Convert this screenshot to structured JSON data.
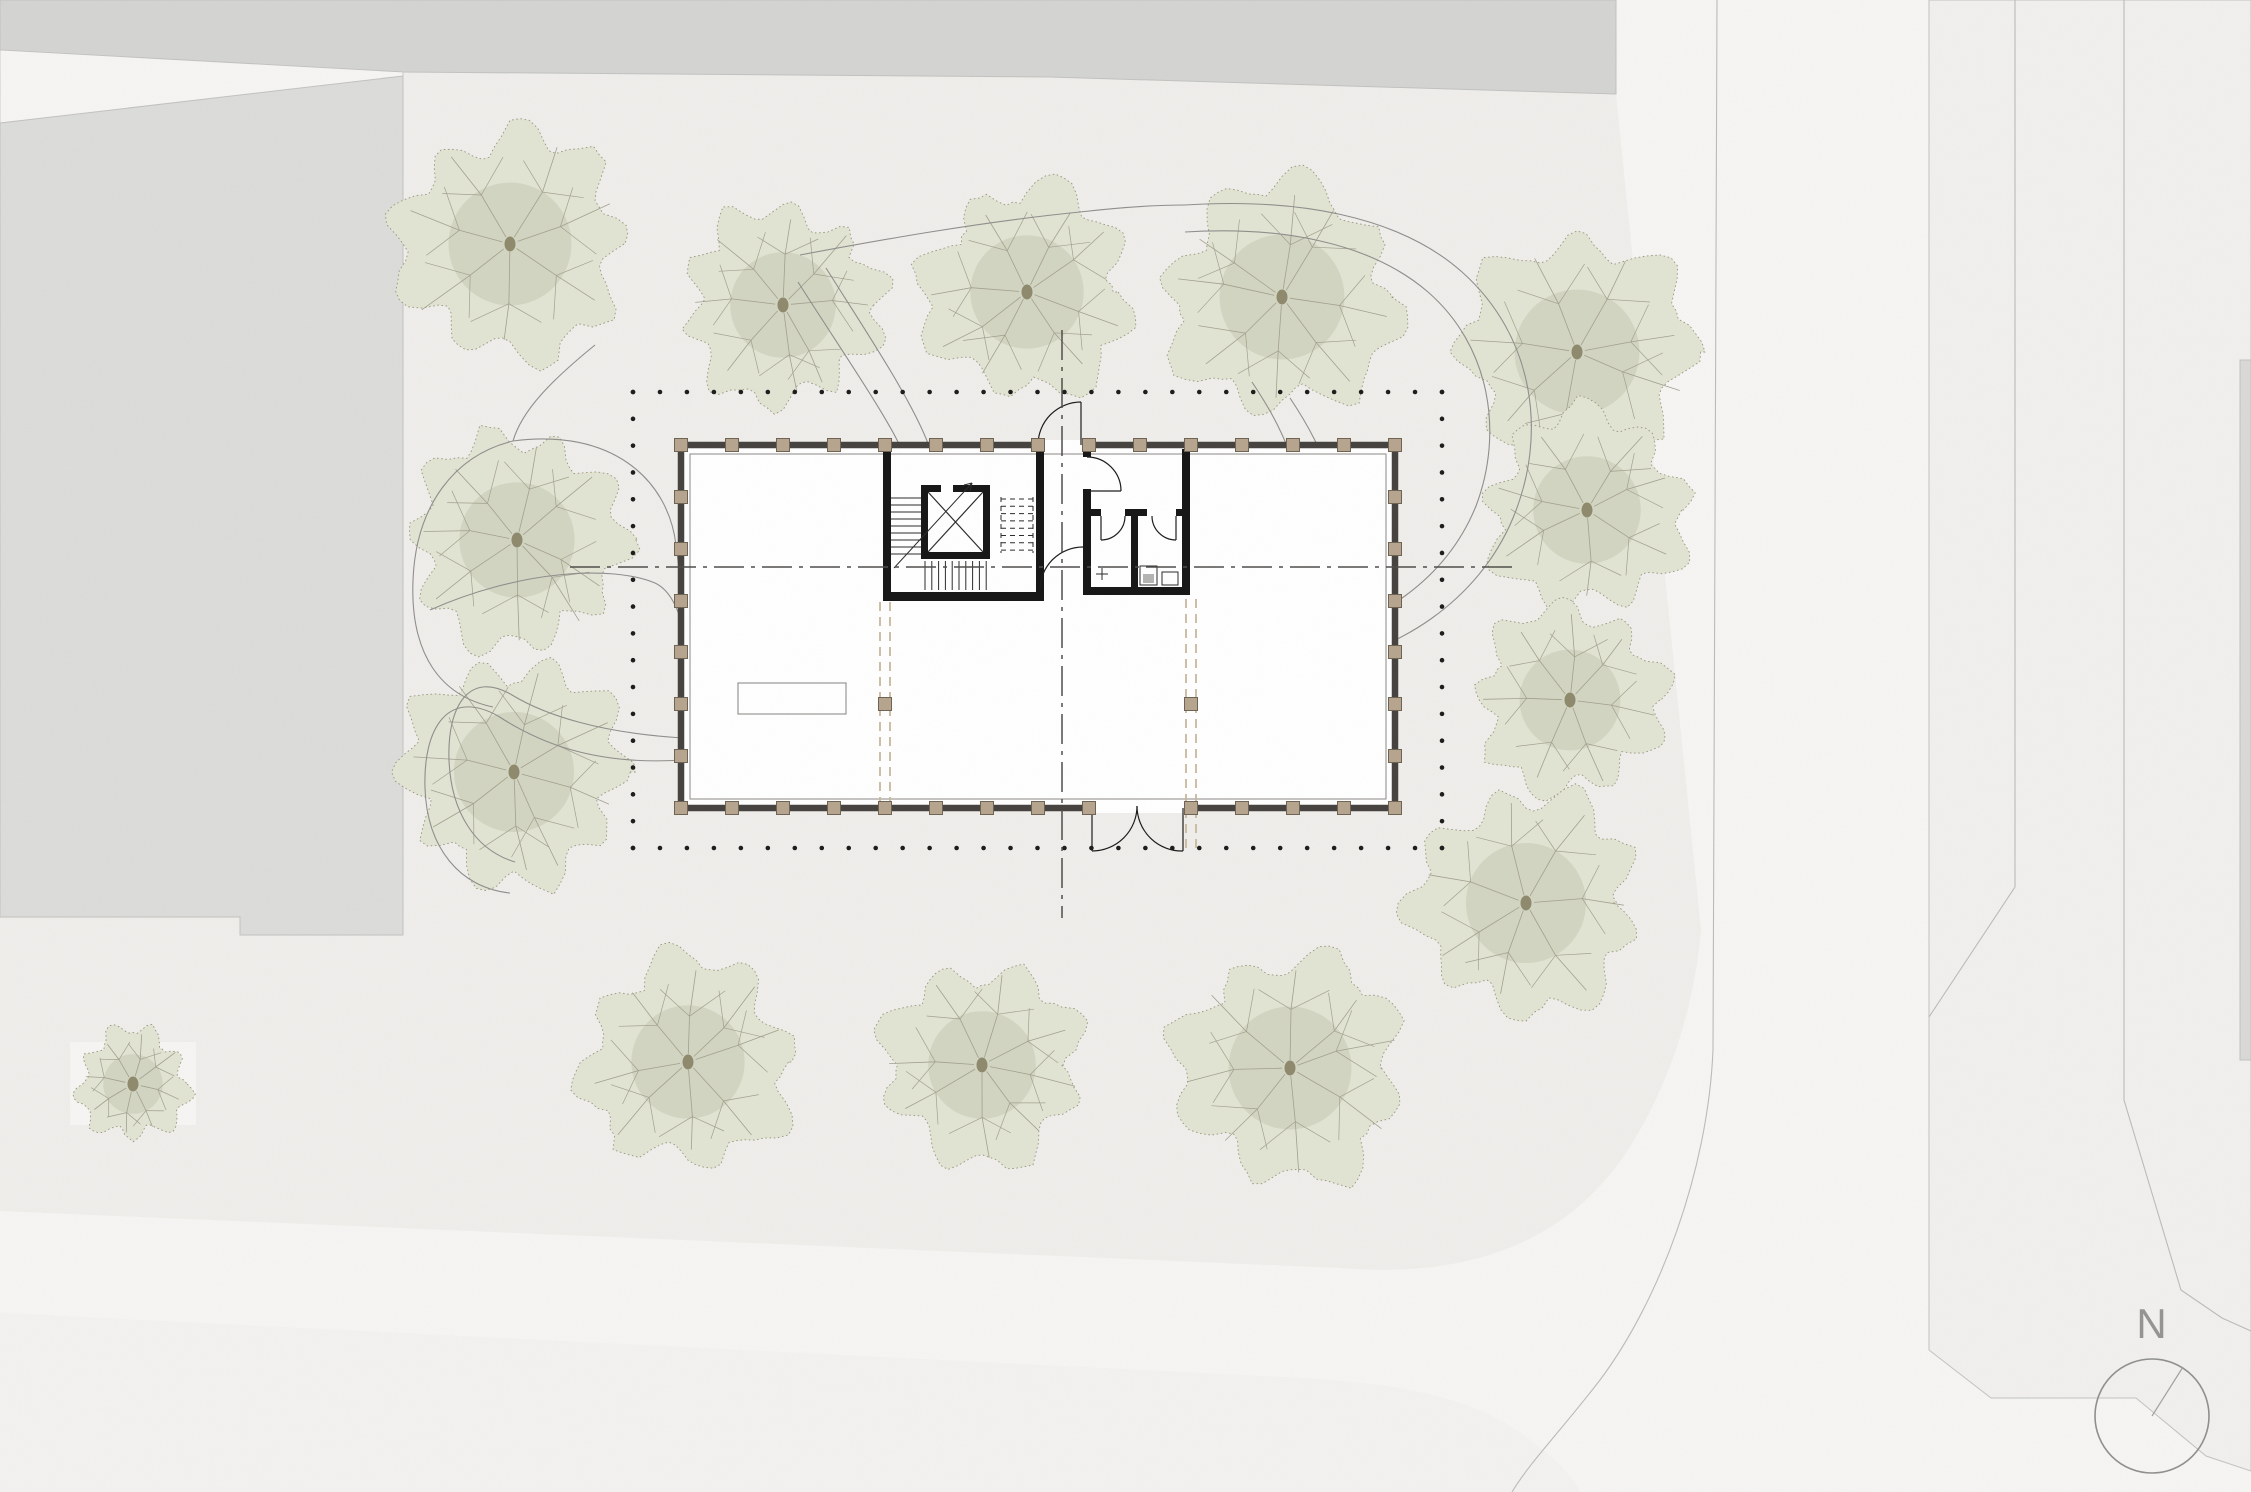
{
  "compass": {
    "label": "N"
  },
  "canvas": {
    "width": 2251,
    "height": 1492
  },
  "colors": {
    "site": "#efeeeb",
    "road": "#f6f5f3",
    "roadSouth": "#f3f2f0",
    "sidewalk": "#f1f0ee",
    "bandGray": "#d4d4d2",
    "leftBlock": "#dcdcda",
    "trBlock": "#d6d6d4",
    "sliver": "#d9d9d7",
    "blockEdge": "#c2c2c0",
    "roadLine": "#bcbbb9",
    "pathLine": "#8f8e8c",
    "dots": "#1c1c1c",
    "centerline": "#4f4d4a",
    "wall": "#454240",
    "wallInner": "#8b8987",
    "core": "#161616",
    "stair": "#2b2b2b",
    "colFill": "#b7a58e",
    "colEdge": "#6f6453",
    "tanDash": "#c9b89f",
    "deskEdge": "#8d8d8b",
    "door": "#1c1c1c",
    "white": "#ffffff",
    "fixtureFill": "#b4b4b2",
    "treeFill": "#e2e4d3",
    "treeEdge": "#9b957e",
    "treeBranch": "#a3a08e",
    "treeInner": "#c2c6af",
    "treeDot": "#8f8a6e",
    "compassRing": "#8f8f8d",
    "needle": "#a0a09e"
  },
  "draw": [
    {
      "t": "rect",
      "n": "site-ground",
      "x": 0,
      "y": 0,
      "w": 2251,
      "h": 1492,
      "fill": "site"
    },
    {
      "t": "path",
      "n": "road-east-south",
      "d": "M1616,0 L1616,94 L1701,930 C1694,1010 1668,1090 1624,1156 C1560,1248 1460,1278 1340,1268 L0,1211 L0,1313 L1300,1378 C1420,1385 1480,1402 1530,1440 C1552,1457 1570,1472 1580,1492 L2251,1492 L2251,0 Z",
      "fill": "road"
    },
    {
      "t": "path",
      "n": "road-south-verge",
      "d": "M0,1313 L1300,1378 C1420,1385 1480,1402 1530,1440 C1552,1457 1570,1472 1580,1492 L0,1492 Z",
      "fill": "roadSouth"
    },
    {
      "t": "poly",
      "n": "block-top-band",
      "p": "0,0 1616,0 1616,94 1050,77 403,72 0,50",
      "fill": "bandGray",
      "stroke": "blockEdge",
      "sw": 1
    },
    {
      "t": "poly",
      "n": "road-top-wedge",
      "p": "0,50 403,72 403,78 0,123",
      "fill": "road",
      "stroke": "blockEdge",
      "sw": 0.8
    },
    {
      "t": "poly",
      "n": "block-left",
      "p": "0,123 403,76 403,935 240,935 240,917 0,917",
      "fill": "leftBlock",
      "stroke": "blockEdge",
      "sw": 1
    },
    {
      "t": "poly",
      "n": "block-top-right",
      "p": "2016,0 2251,0 2251,118 2016,108",
      "fill": "trBlock",
      "stroke": "blockEdge",
      "sw": 1
    },
    {
      "t": "poly",
      "n": "sidewalk-east",
      "p": "1929,0 1929,1350 1991,1398 2136,1398 2206,1456 2251,1471 2251,0",
      "fill": "sidewalk",
      "stroke": "blockEdge",
      "sw": 1
    },
    {
      "t": "rect",
      "n": "block-east-sliver",
      "x": 2240,
      "y": 360,
      "w": 11,
      "h": 700,
      "fill": "sliver",
      "stroke": "blockEdge",
      "sw": 1
    },
    {
      "t": "rect",
      "n": "small-tree-plot",
      "x": 70,
      "y": 1042,
      "w": 126,
      "h": 83,
      "fill": "road"
    },
    {
      "t": "path",
      "n": "curb-east",
      "d": "M1717,0 L1713,1050 C1708,1170 1660,1300 1600,1380 C1560,1432 1530,1462 1512,1492",
      "stroke": "roadLine",
      "sw": 1.1
    },
    {
      "t": "path",
      "n": "curb-east-lane",
      "d": "M2015,0 L2015,887 L1929,1017",
      "stroke": "roadLine",
      "sw": 1.1
    },
    {
      "t": "path",
      "n": "curb-east-outer",
      "d": "M2124,0 L2124,1100 L2181,1290 L2222,1318 L2251,1331",
      "stroke": "roadLine",
      "sw": 1.1
    },
    {
      "t": "tree",
      "n": "tree",
      "cx": 510,
      "cy": 244,
      "r": 128,
      "seed": 11
    },
    {
      "t": "tree",
      "n": "tree",
      "cx": 783,
      "cy": 305,
      "r": 110,
      "seed": 23
    },
    {
      "t": "tree",
      "n": "tree",
      "cx": 1027,
      "cy": 292,
      "r": 118,
      "seed": 37
    },
    {
      "t": "tree",
      "n": "tree",
      "cx": 1282,
      "cy": 297,
      "r": 130,
      "seed": 41
    },
    {
      "t": "tree",
      "n": "tree",
      "cx": 1577,
      "cy": 352,
      "r": 130,
      "seed": 53
    },
    {
      "t": "tree",
      "n": "tree",
      "cx": 1587,
      "cy": 510,
      "r": 112,
      "seed": 67
    },
    {
      "t": "tree",
      "n": "tree",
      "cx": 1570,
      "cy": 700,
      "r": 105,
      "seed": 71
    },
    {
      "t": "tree",
      "n": "tree",
      "cx": 1526,
      "cy": 903,
      "r": 125,
      "seed": 83
    },
    {
      "t": "tree",
      "n": "tree",
      "cx": 517,
      "cy": 540,
      "r": 120,
      "seed": 97
    },
    {
      "t": "tree",
      "n": "tree",
      "cx": 514,
      "cy": 772,
      "r": 125,
      "seed": 103
    },
    {
      "t": "tree",
      "n": "tree",
      "cx": 688,
      "cy": 1062,
      "r": 118,
      "seed": 113
    },
    {
      "t": "tree",
      "n": "tree",
      "cx": 982,
      "cy": 1065,
      "r": 112,
      "seed": 127
    },
    {
      "t": "tree",
      "n": "tree",
      "cx": 1290,
      "cy": 1068,
      "r": 128,
      "seed": 131
    },
    {
      "t": "tree",
      "n": "tree-small",
      "cx": 133,
      "cy": 1084,
      "r": 62,
      "seed": 139
    },
    {
      "t": "path",
      "n": "footpath",
      "d": "M595,345 C552,380 522,410 513,441",
      "stroke": "pathLine",
      "sw": 1.1
    },
    {
      "t": "path",
      "n": "footpath",
      "d": "M513,441 C455,455 416,505 413,580 C410,655 441,696 493,707",
      "stroke": "pathLine",
      "sw": 1.1
    },
    {
      "t": "path",
      "n": "footpath",
      "d": "M513,441 C610,428 668,478 676,545 C679,568 681,585 683,605",
      "stroke": "pathLine",
      "sw": 1.1
    },
    {
      "t": "path",
      "n": "footpath",
      "d": "M430,610 C520,570 612,565 655,583 C670,590 678,608 683,628",
      "stroke": "pathLine",
      "sw": 1.1
    },
    {
      "t": "path",
      "n": "footpath",
      "d": "M683,605 C840,612 988,625 988,700 C988,775 840,766 683,760",
      "stroke": "pathLine",
      "sw": 1.1
    },
    {
      "t": "path",
      "n": "footpath",
      "d": "M683,628 C805,633 942,650 942,700 C942,750 805,742 683,738",
      "stroke": "pathLine",
      "sw": 1.1
    },
    {
      "t": "path",
      "n": "footpath",
      "d": "M683,760 C590,766 535,740 498,716 C448,688 423,728 425,788 C427,848 460,888 510,893",
      "stroke": "pathLine",
      "sw": 1.1
    },
    {
      "t": "path",
      "n": "footpath",
      "d": "M683,738 C600,733 545,715 512,695 C470,670 447,705 449,760 C451,812 475,850 515,862",
      "stroke": "pathLine",
      "sw": 1.1
    },
    {
      "t": "path",
      "n": "footpath",
      "d": "M800,255 C880,240 980,222 1080,212 C1115,208 1150,205 1185,205",
      "stroke": "pathLine",
      "sw": 1.1
    },
    {
      "t": "path",
      "n": "footpath",
      "d": "M826,268 C865,330 912,400 929,446",
      "stroke": "pathLine",
      "sw": 1.1
    },
    {
      "t": "path",
      "n": "footpath",
      "d": "M798,282 C838,345 884,412 900,446",
      "stroke": "pathLine",
      "sw": 1.1
    },
    {
      "t": "path",
      "n": "footpath",
      "d": "M1185,205 C1295,198 1398,215 1462,272 C1534,336 1548,434 1513,518 C1478,602 1396,653 1318,664 C1266,671 1234,650 1229,612",
      "stroke": "pathLine",
      "sw": 1.1
    },
    {
      "t": "path",
      "n": "footpath",
      "d": "M1185,232 C1280,226 1370,242 1428,292 C1490,346 1504,432 1476,506 C1446,580 1376,626 1307,637 C1264,643 1242,628 1238,597",
      "stroke": "pathLine",
      "sw": 1.1
    },
    {
      "t": "path",
      "n": "footpath",
      "d": "M1252,382 C1272,412 1286,438 1296,472 C1307,510 1316,542 1323,568",
      "stroke": "pathLine",
      "sw": 1.1
    },
    {
      "t": "path",
      "n": "footpath",
      "d": "M1290,398 C1310,428 1322,452 1331,480 C1339,506 1347,527 1353,545",
      "stroke": "pathLine",
      "sw": 1.1
    },
    {
      "t": "dots",
      "n": "roof-projection-top",
      "x1": 633,
      "y1": 392,
      "x2": 1442,
      "y2": 392,
      "sp": 27,
      "r": 2.3
    },
    {
      "t": "dots",
      "n": "roof-projection-bottom",
      "x1": 633,
      "y1": 848,
      "x2": 1442,
      "y2": 848,
      "sp": 27,
      "r": 2.3
    },
    {
      "t": "dots",
      "n": "roof-projection-left",
      "x1": 633,
      "y1": 392,
      "x2": 633,
      "y2": 848,
      "sp": 27,
      "r": 2.3
    },
    {
      "t": "dots",
      "n": "roof-projection-right",
      "x1": 1442,
      "y1": 392,
      "x2": 1442,
      "y2": 848,
      "sp": 27,
      "r": 2.3
    },
    {
      "t": "rect",
      "n": "building-floor",
      "x": 681,
      "y": 445,
      "w": 714,
      "h": 363,
      "fill": "white",
      "stroke": "wall",
      "sw": 6.5
    },
    {
      "t": "rect",
      "n": "building-glazing-line",
      "x": 690,
      "y": 454,
      "w": 696,
      "h": 345,
      "fill": "none",
      "stroke": "wallInner",
      "sw": 1
    },
    {
      "t": "rect",
      "n": "door-opening-mask",
      "x": 1036,
      "y": 440,
      "w": 47,
      "h": 10,
      "fill": "white"
    },
    {
      "t": "rect",
      "n": "door-opening-mask",
      "x": 1090,
      "y": 803,
      "w": 95,
      "h": 10,
      "fill": "white"
    },
    {
      "t": "line",
      "n": "void-edge-dashed",
      "x1": 880,
      "y1": 602,
      "x2": 880,
      "y2": 810,
      "stroke": "tanDash",
      "sw": 1.8,
      "dash": "9 6"
    },
    {
      "t": "line",
      "n": "void-edge-dashed",
      "x1": 890,
      "y1": 602,
      "x2": 890,
      "y2": 810,
      "stroke": "tanDash",
      "sw": 1.8,
      "dash": "9 6"
    },
    {
      "t": "line",
      "n": "void-edge-dashed",
      "x1": 1186,
      "y1": 599,
      "x2": 1186,
      "y2": 848,
      "stroke": "tanDash",
      "sw": 1.8,
      "dash": "9 6"
    },
    {
      "t": "line",
      "n": "void-edge-dashed",
      "x1": 1196,
      "y1": 599,
      "x2": 1196,
      "y2": 848,
      "stroke": "tanDash",
      "sw": 1.8,
      "dash": "9 6"
    },
    {
      "t": "rect",
      "n": "reception-desk",
      "x": 738,
      "y": 683,
      "w": 108,
      "h": 31,
      "fill": "white",
      "stroke": "deskEdge",
      "sw": 1.1
    },
    {
      "t": "rect",
      "n": "stair-core-wall",
      "x": 883,
      "y": 449,
      "w": 8,
      "h": 150,
      "fill": "core"
    },
    {
      "t": "rect",
      "n": "stair-core-wall",
      "x": 883,
      "y": 592,
      "w": 161,
      "h": 9,
      "fill": "core"
    },
    {
      "t": "rect",
      "n": "stair-core-wall",
      "x": 1036,
      "y": 449,
      "w": 8,
      "h": 152,
      "fill": "core"
    },
    {
      "t": "rect",
      "n": "elevator-wall",
      "x": 921,
      "y": 485,
      "w": 20,
      "h": 7,
      "fill": "core"
    },
    {
      "t": "rect",
      "n": "elevator-wall",
      "x": 953,
      "y": 485,
      "w": 37,
      "h": 7,
      "fill": "core"
    },
    {
      "t": "rect",
      "n": "elevator-wall",
      "x": 921,
      "y": 485,
      "w": 7,
      "h": 74,
      "fill": "core"
    },
    {
      "t": "rect",
      "n": "elevator-wall",
      "x": 983,
      "y": 485,
      "w": 7,
      "h": 74,
      "fill": "core"
    },
    {
      "t": "rect",
      "n": "elevator-wall",
      "x": 921,
      "y": 552,
      "w": 69,
      "h": 7,
      "fill": "core"
    },
    {
      "t": "line",
      "n": "elevator-x",
      "x1": 928,
      "y1": 492,
      "x2": 983,
      "y2": 552,
      "stroke": "stair",
      "sw": 1.2
    },
    {
      "t": "line",
      "n": "elevator-x",
      "x1": 983,
      "y1": 492,
      "x2": 928,
      "y2": 552,
      "stroke": "stair",
      "sw": 1.2
    },
    {
      "t": "stairs",
      "n": "stair-treads-left",
      "x1": 891,
      "x2": 921,
      "y": 498,
      "step": 7,
      "count": 9,
      "dir": "h"
    },
    {
      "t": "stairs",
      "n": "stair-treads-bottom",
      "y1": 561,
      "y2": 590,
      "x": 925,
      "step": 6.8,
      "count": 10,
      "dir": "v"
    },
    {
      "t": "stairs",
      "n": "stair-treads-upper-dashed",
      "x1": 1001,
      "x2": 1033,
      "y": 499,
      "step": 7.3,
      "count": 8,
      "dir": "h",
      "dash": "5 4"
    },
    {
      "t": "line",
      "n": "stair-flight-edge",
      "x1": 1001,
      "y1": 497,
      "x2": 1001,
      "y2": 553,
      "stroke": "stair",
      "sw": 1,
      "dash": "5 4"
    },
    {
      "t": "line",
      "n": "stair-flight-edge",
      "x1": 1033,
      "y1": 497,
      "x2": 1033,
      "y2": 553,
      "stroke": "stair",
      "sw": 1,
      "dash": "5 4"
    },
    {
      "t": "line",
      "n": "stair-direction",
      "x1": 894,
      "y1": 568,
      "x2": 972,
      "y2": 483,
      "stroke": "stair",
      "sw": 1
    },
    {
      "t": "line",
      "n": "stair-arrow",
      "x1": 972,
      "y1": 483,
      "x2": 964,
      "y2": 485,
      "stroke": "stair",
      "sw": 1
    },
    {
      "t": "line",
      "n": "stair-arrow",
      "x1": 972,
      "y1": 483,
      "x2": 970,
      "y2": 491,
      "stroke": "stair",
      "sw": 1
    },
    {
      "t": "rect",
      "n": "wc-core-wall",
      "x": 1083,
      "y": 449,
      "w": 8,
      "h": 8,
      "fill": "core"
    },
    {
      "t": "rect",
      "n": "wc-core-wall",
      "x": 1083,
      "y": 489,
      "w": 8,
      "h": 106,
      "fill": "core"
    },
    {
      "t": "rect",
      "n": "wc-core-wall",
      "x": 1182,
      "y": 449,
      "w": 8,
      "h": 146,
      "fill": "core"
    },
    {
      "t": "rect",
      "n": "wc-core-wall",
      "x": 1083,
      "y": 587,
      "w": 107,
      "h": 8,
      "fill": "core"
    },
    {
      "t": "rect",
      "n": "wc-partition",
      "x": 1091,
      "y": 509,
      "w": 10,
      "h": 7,
      "fill": "core"
    },
    {
      "t": "rect",
      "n": "wc-partition",
      "x": 1125,
      "y": 509,
      "w": 22,
      "h": 7,
      "fill": "core"
    },
    {
      "t": "rect",
      "n": "wc-partition",
      "x": 1176,
      "y": 509,
      "w": 6,
      "h": 7,
      "fill": "core"
    },
    {
      "t": "rect",
      "n": "wc-divider",
      "x": 1131,
      "y": 516,
      "w": 7,
      "h": 71,
      "fill": "core"
    },
    {
      "t": "rect",
      "n": "wc-fixture",
      "x": 1140,
      "y": 566,
      "w": 17,
      "h": 19,
      "fill": "none",
      "stroke": "stair",
      "sw": 1
    },
    {
      "t": "rect",
      "n": "wc-fixture",
      "x": 1162,
      "y": 572,
      "w": 16,
      "h": 13,
      "fill": "none",
      "stroke": "stair",
      "sw": 1
    },
    {
      "t": "rect",
      "n": "wc-fixture-fill",
      "x": 1143,
      "y": 574,
      "w": 11,
      "h": 9,
      "fill": "fixtureFill"
    },
    {
      "t": "line",
      "n": "wc-mark",
      "x1": 1096,
      "y1": 574,
      "x2": 1108,
      "y2": 574,
      "stroke": "stair",
      "sw": 1
    },
    {
      "t": "line",
      "n": "wc-mark",
      "x1": 1102,
      "y1": 568,
      "x2": 1102,
      "y2": 580,
      "stroke": "stair",
      "sw": 1
    },
    {
      "t": "path",
      "n": "door-swing",
      "d": "M1038,445 A43,43 0 0 1 1081,402",
      "stroke": "door",
      "sw": 1.2
    },
    {
      "t": "line",
      "n": "door-leaf",
      "x1": 1081,
      "y1": 445,
      "x2": 1081,
      "y2": 402,
      "stroke": "door",
      "sw": 1.2
    },
    {
      "t": "path",
      "n": "door-swing",
      "d": "M1092,851 A45,45 0 0 0 1137,806",
      "stroke": "door",
      "sw": 1.2
    },
    {
      "t": "line",
      "n": "door-leaf",
      "x1": 1092,
      "y1": 808,
      "x2": 1092,
      "y2": 851,
      "stroke": "door",
      "sw": 1.2
    },
    {
      "t": "path",
      "n": "door-swing",
      "d": "M1183,851 A45,45 0 0 1 1137,806",
      "stroke": "door",
      "sw": 1.2
    },
    {
      "t": "line",
      "n": "door-leaf",
      "x1": 1183,
      "y1": 808,
      "x2": 1183,
      "y2": 851,
      "stroke": "door",
      "sw": 1.2
    },
    {
      "t": "path",
      "n": "door-swing",
      "d": "M1087,457 A34,34 0 0 1 1121,491",
      "stroke": "door",
      "sw": 1.2
    },
    {
      "t": "line",
      "n": "door-leaf",
      "x1": 1087,
      "y1": 491,
      "x2": 1121,
      "y2": 491,
      "stroke": "door",
      "sw": 1.2
    },
    {
      "t": "path",
      "n": "door-swing",
      "d": "M1101,540 A24,24 0 0 0 1125,516",
      "stroke": "door",
      "sw": 1.2
    },
    {
      "t": "line",
      "n": "door-leaf",
      "x1": 1101,
      "y1": 516,
      "x2": 1101,
      "y2": 540,
      "stroke": "door",
      "sw": 1.2
    },
    {
      "t": "path",
      "n": "door-swing",
      "d": "M1176,540 A24,24 0 0 1 1152,516",
      "stroke": "door",
      "sw": 1.2
    },
    {
      "t": "line",
      "n": "door-leaf",
      "x1": 1176,
      "y1": 516,
      "x2": 1176,
      "y2": 540,
      "stroke": "door",
      "sw": 1.2
    },
    {
      "t": "path",
      "n": "door-swing",
      "d": "M1040,590 A43,43 0 0 1 1083,547",
      "stroke": "door",
      "sw": 1.2
    },
    {
      "t": "squares",
      "n": "column",
      "size": 13,
      "fill": "colFill",
      "stroke": "colEdge",
      "cs": [
        [
          681,
          445
        ],
        [
          732,
          445
        ],
        [
          783,
          445
        ],
        [
          834,
          445
        ],
        [
          885,
          445
        ],
        [
          936,
          445
        ],
        [
          987,
          445
        ],
        [
          1038,
          445
        ],
        [
          1089,
          445
        ],
        [
          1140,
          445
        ],
        [
          1191,
          445
        ],
        [
          1242,
          445
        ],
        [
          1293,
          445
        ],
        [
          1344,
          445
        ],
        [
          1395,
          445
        ],
        [
          681,
          808
        ],
        [
          732,
          808
        ],
        [
          783,
          808
        ],
        [
          834,
          808
        ],
        [
          885,
          808
        ],
        [
          936,
          808
        ],
        [
          987,
          808
        ],
        [
          1038,
          808
        ],
        [
          1089,
          808
        ],
        [
          1191,
          808
        ],
        [
          1242,
          808
        ],
        [
          1293,
          808
        ],
        [
          1344,
          808
        ],
        [
          1395,
          808
        ],
        [
          681,
          497
        ],
        [
          681,
          549
        ],
        [
          681,
          601
        ],
        [
          681,
          652
        ],
        [
          681,
          704
        ],
        [
          681,
          756
        ],
        [
          1395,
          497
        ],
        [
          1395,
          549
        ],
        [
          1395,
          601
        ],
        [
          1395,
          652
        ],
        [
          1395,
          704
        ],
        [
          1395,
          756
        ],
        [
          885,
          704
        ],
        [
          1191,
          704
        ]
      ]
    },
    {
      "t": "path",
      "n": "centerline-horizontal",
      "d": "M570,567 L1515,567",
      "stroke": "centerline",
      "sw": 1.5,
      "dash": "30 7 4 7"
    },
    {
      "t": "path",
      "n": "centerline-vertical",
      "d": "M1062,330 L1062,918",
      "stroke": "centerline",
      "sw": 1.5,
      "dash": "30 7 4 7"
    },
    {
      "t": "circle",
      "n": "north-ring",
      "cx": 2152,
      "cy": 1416,
      "r": 57,
      "fill": "none",
      "stroke": "compassRing",
      "sw": 1.6
    },
    {
      "t": "line",
      "n": "north-needle",
      "x1": 2152,
      "y1": 1416,
      "x2": 2183,
      "y2": 1367,
      "stroke": "needle",
      "sw": 1.2
    }
  ]
}
